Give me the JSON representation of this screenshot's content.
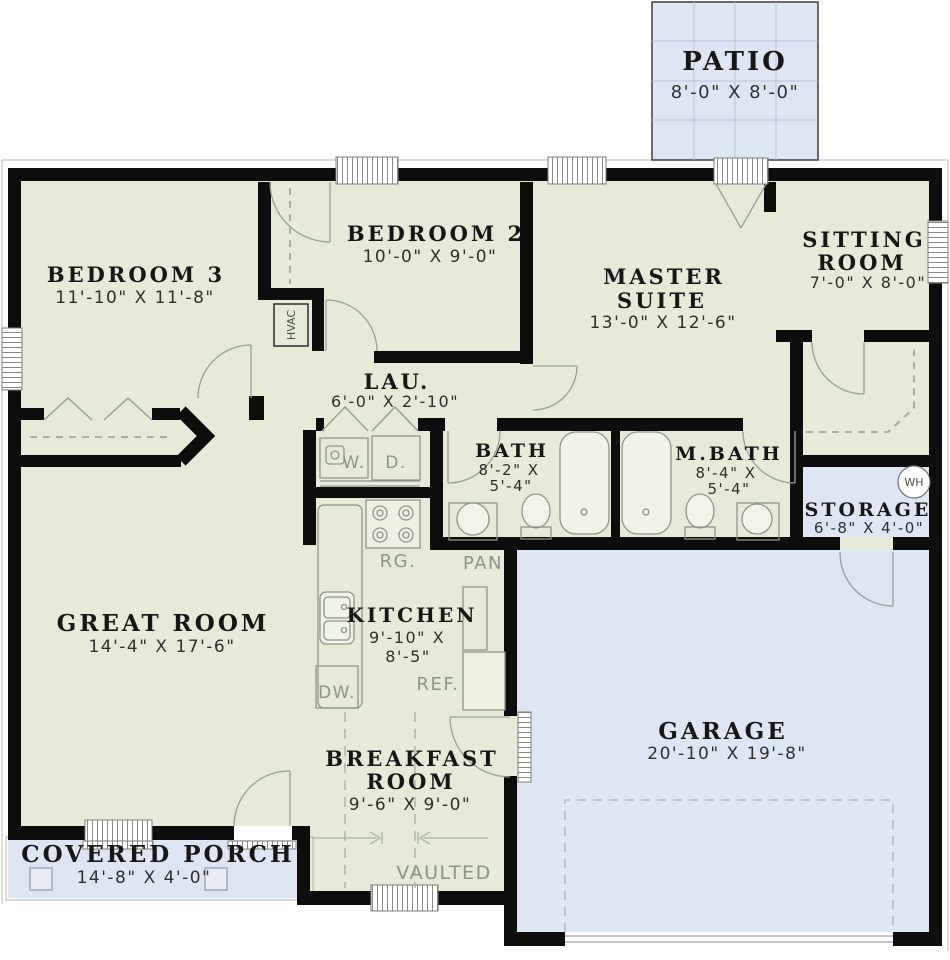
{
  "title": "Floor plan",
  "colors": {
    "wall": "#0d0d0d",
    "interior_fill": "#e5ebd8",
    "outdoor_fill": "#dfe6f3",
    "thin_line": "#8f958b",
    "text": "#1a1a1a",
    "gray_label": "#8d9389"
  },
  "rooms": {
    "patio": {
      "name": "PATIO",
      "dims": "8'-0\" X 8'-0\""
    },
    "bedroom3": {
      "name": "BEDROOM 3",
      "dims": "11'-10\" X 11'-8\""
    },
    "bedroom2": {
      "name": "BEDROOM 2",
      "dims": "10'-0\" X 9'-0\""
    },
    "master": {
      "lines": [
        "MASTER",
        "SUITE"
      ],
      "dims": "13'-0\" X 12'-6\""
    },
    "sitting": {
      "lines": [
        "SITTING",
        "ROOM"
      ],
      "dims": "7'-0\" X 8'-0\""
    },
    "laundry": {
      "name": "LAU.",
      "dims": "6'-0\" X 2'-10\""
    },
    "bath": {
      "name": "BATH",
      "dims": [
        "8'-2\" X",
        "5'-4\""
      ]
    },
    "mbath": {
      "name": "M.BATH",
      "dims": [
        "8'-4\" X",
        "5'-4\""
      ]
    },
    "storage": {
      "name": "STORAGE",
      "dims": "6'-8\" X 4'-0\""
    },
    "great": {
      "name": "GREAT ROOM",
      "dims": "14'-4\" X 17'-6\""
    },
    "kitchen": {
      "name": "KITCHEN",
      "dims": [
        "9'-10\" X",
        "8'-5\""
      ]
    },
    "garage": {
      "name": "GARAGE",
      "dims": "20'-10\" X 19'-8\""
    },
    "breakfast": {
      "lines": [
        "BREAKFAST",
        "ROOM"
      ],
      "dims": "9'-6\" X 9'-0\""
    },
    "porch": {
      "name": "COVERED PORCH",
      "dims": "14'-8\" X 4'-0\""
    }
  },
  "labels": {
    "hvac": "HVAC",
    "water_heater": "WH",
    "washer": "W.",
    "dryer": "D.",
    "range": "RG.",
    "pantry": "PAN",
    "refrigerator": "REF.",
    "dishwasher": "DW.",
    "vaulted": "VAULTED"
  }
}
